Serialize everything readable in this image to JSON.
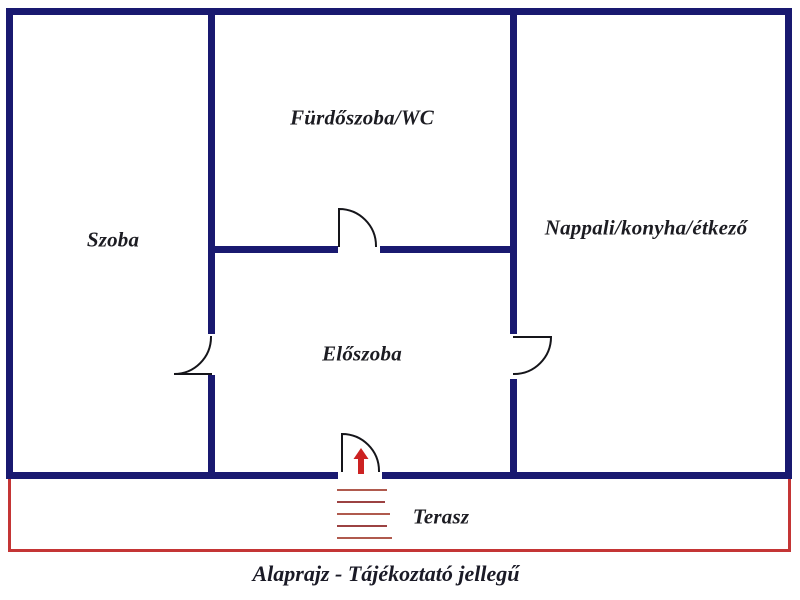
{
  "rooms": {
    "szoba": {
      "label": "Szoba"
    },
    "furdoszoba": {
      "label": "Fürdőszoba/WC"
    },
    "nappali": {
      "label": "Nappali/konyha/étkező"
    },
    "eloszoba": {
      "label": "Előszoba"
    },
    "terasz": {
      "label": "Terasz"
    }
  },
  "caption": "Alaprajz - Tájékoztató jellegű",
  "symbols": {
    "doors": 4,
    "entry_arrow": "up-arrow",
    "terrace_step_lines": 5
  },
  "colors": {
    "wall": "#191970",
    "terrace_outline": "#c43535",
    "steps_light": "#b05a4e",
    "steps_dark": "#9c4242",
    "arrow": "#cc2222",
    "label_text": "#1c1c22",
    "background": "#ffffff"
  }
}
